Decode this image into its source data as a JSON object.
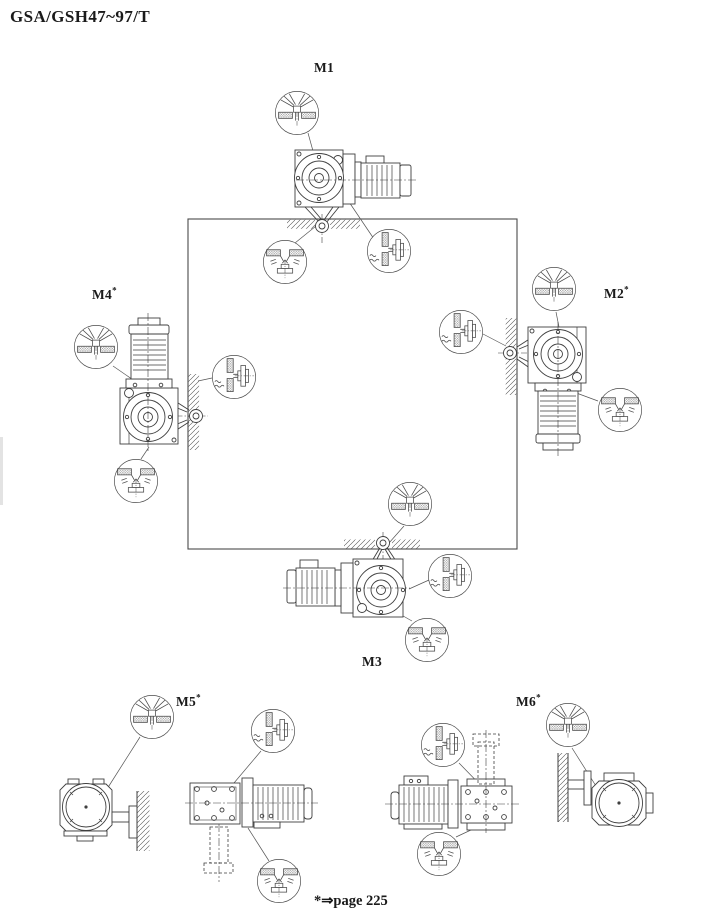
{
  "page": {
    "title": "GSA/GSH47~97/T",
    "footnote_marker": "*",
    "footnote_arrow": "⇒",
    "footnote_text": "page 225"
  },
  "mounting_positions": [
    {
      "label": "M1",
      "sup": ""
    },
    {
      "label": "M2",
      "sup": "*"
    },
    {
      "label": "M3",
      "sup": ""
    },
    {
      "label": "M4",
      "sup": "*"
    },
    {
      "label": "M5",
      "sup": "*"
    },
    {
      "label": "M6",
      "sup": "*"
    }
  ],
  "symbols": {
    "vent": "breather-vent-plug",
    "level": "oil-level-plug",
    "drain": "oil-drain-plug"
  },
  "colors": {
    "ink": "#3f3f3f",
    "thin": "#555555",
    "hatch": "#777777",
    "background": "#ffffff"
  }
}
